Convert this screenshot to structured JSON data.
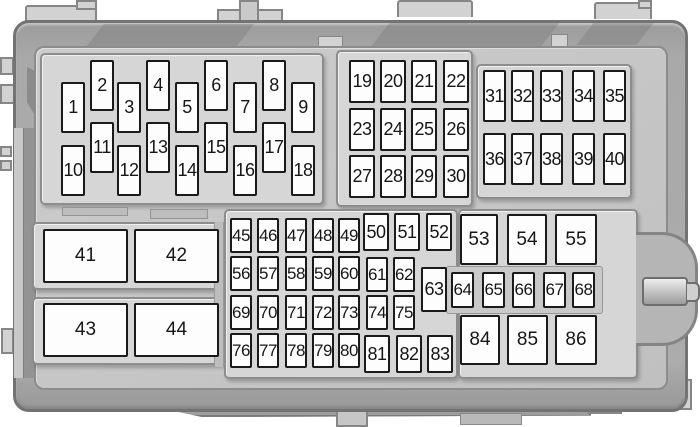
{
  "diagram": {
    "kind": "fuse-box",
    "fuse_fill": "#fdfdfd",
    "fuse_border": "#1a1a1a",
    "label_color": "#161616",
    "housing_color": "#a9a9a9",
    "panel_color": "#c6c6c6",
    "tray_color": "#d6d6d6",
    "background": "#ffffff"
  },
  "fuse_groups": [
    {
      "name": "fuse-block-1-18",
      "kind": "fuse",
      "cls": "",
      "w": 24,
      "h": 51,
      "fuses": [
        {
          "l": "1",
          "x": 61,
          "y": 82
        },
        {
          "l": "2",
          "x": 90,
          "y": 60
        },
        {
          "l": "3",
          "x": 117,
          "y": 82
        },
        {
          "l": "4",
          "x": 146,
          "y": 60
        },
        {
          "l": "5",
          "x": 175,
          "y": 82
        },
        {
          "l": "6",
          "x": 204,
          "y": 60
        },
        {
          "l": "7",
          "x": 233,
          "y": 82
        },
        {
          "l": "8",
          "x": 262,
          "y": 60
        },
        {
          "l": "9",
          "x": 291,
          "y": 82
        },
        {
          "l": "10",
          "x": 61,
          "y": 145
        },
        {
          "l": "11",
          "x": 90,
          "y": 122
        },
        {
          "l": "12",
          "x": 117,
          "y": 145
        },
        {
          "l": "13",
          "x": 146,
          "y": 122
        },
        {
          "l": "14",
          "x": 175,
          "y": 145
        },
        {
          "l": "15",
          "x": 204,
          "y": 122
        },
        {
          "l": "16",
          "x": 233,
          "y": 145
        },
        {
          "l": "17",
          "x": 262,
          "y": 122
        },
        {
          "l": "18",
          "x": 291,
          "y": 145
        }
      ]
    },
    {
      "name": "fuse-block-19-30",
      "kind": "fuse",
      "cls": "",
      "w": 26,
      "h": 43,
      "fuses": [
        {
          "l": "19",
          "x": 349,
          "y": 60
        },
        {
          "l": "20",
          "x": 380,
          "y": 60
        },
        {
          "l": "21",
          "x": 411,
          "y": 60
        },
        {
          "l": "22",
          "x": 443,
          "y": 60
        },
        {
          "l": "23",
          "x": 349,
          "y": 108
        },
        {
          "l": "24",
          "x": 380,
          "y": 108
        },
        {
          "l": "25",
          "x": 411,
          "y": 108
        },
        {
          "l": "26",
          "x": 443,
          "y": 108
        },
        {
          "l": "27",
          "x": 349,
          "y": 155
        },
        {
          "l": "28",
          "x": 380,
          "y": 155
        },
        {
          "l": "29",
          "x": 411,
          "y": 155
        },
        {
          "l": "30",
          "x": 443,
          "y": 155
        }
      ]
    },
    {
      "name": "fuse-block-31-40",
      "kind": "fuse",
      "cls": "",
      "w": 23,
      "h": 52,
      "fuses": [
        {
          "l": "31",
          "x": 483,
          "y": 70
        },
        {
          "l": "32",
          "x": 511,
          "y": 70
        },
        {
          "l": "33",
          "x": 540,
          "y": 70
        },
        {
          "l": "34",
          "x": 572,
          "y": 70
        },
        {
          "l": "35",
          "x": 603,
          "y": 70
        },
        {
          "l": "36",
          "x": 483,
          "y": 133
        },
        {
          "l": "37",
          "x": 511,
          "y": 133
        },
        {
          "l": "38",
          "x": 540,
          "y": 133
        },
        {
          "l": "39",
          "x": 572,
          "y": 133
        },
        {
          "l": "40",
          "x": 603,
          "y": 133
        }
      ]
    },
    {
      "name": "relay-block-41-44",
      "kind": "relay",
      "cls": "lg",
      "w": 85,
      "h": 54,
      "fuses": [
        {
          "l": "41",
          "x": 43,
          "y": 229
        },
        {
          "l": "42",
          "x": 134,
          "y": 229
        },
        {
          "l": "43",
          "x": 43,
          "y": 303
        },
        {
          "l": "44",
          "x": 134,
          "y": 303
        }
      ]
    },
    {
      "name": "lower-grid-small-fuses",
      "kind": "fuse",
      "cls": "sm",
      "w": 22,
      "h": 35,
      "fuses": [
        {
          "l": "45",
          "x": 230,
          "y": 218
        },
        {
          "l": "46",
          "x": 257,
          "y": 218
        },
        {
          "l": "47",
          "x": 285,
          "y": 218
        },
        {
          "l": "48",
          "x": 312,
          "y": 218
        },
        {
          "l": "49",
          "x": 338,
          "y": 218
        },
        {
          "l": "56",
          "x": 230,
          "y": 256
        },
        {
          "l": "57",
          "x": 257,
          "y": 256
        },
        {
          "l": "58",
          "x": 285,
          "y": 256
        },
        {
          "l": "59",
          "x": 312,
          "y": 256
        },
        {
          "l": "60",
          "x": 338,
          "y": 256
        },
        {
          "l": "61",
          "x": 366,
          "y": 257
        },
        {
          "l": "62",
          "x": 393,
          "y": 257
        },
        {
          "l": "69",
          "x": 230,
          "y": 295
        },
        {
          "l": "70",
          "x": 257,
          "y": 295
        },
        {
          "l": "71",
          "x": 285,
          "y": 295
        },
        {
          "l": "72",
          "x": 312,
          "y": 295
        },
        {
          "l": "73",
          "x": 338,
          "y": 295
        },
        {
          "l": "74",
          "x": 366,
          "y": 295
        },
        {
          "l": "75",
          "x": 393,
          "y": 295
        },
        {
          "l": "76",
          "x": 230,
          "y": 333
        },
        {
          "l": "77",
          "x": 257,
          "y": 333
        },
        {
          "l": "78",
          "x": 285,
          "y": 333
        },
        {
          "l": "79",
          "x": 312,
          "y": 333
        },
        {
          "l": "80",
          "x": 338,
          "y": 333
        }
      ]
    },
    {
      "name": "lower-grid-large-fuses",
      "kind": "fuse",
      "cls": "",
      "w": 26,
      "h": 38,
      "fuses": [
        {
          "l": "50",
          "x": 363,
          "y": 213
        },
        {
          "l": "51",
          "x": 394,
          "y": 213
        },
        {
          "l": "52",
          "x": 426,
          "y": 213
        },
        {
          "l": "63",
          "x": 421,
          "y": 267,
          "h": 45
        },
        {
          "l": "81",
          "x": 364,
          "y": 335
        },
        {
          "l": "82",
          "x": 396,
          "y": 335
        },
        {
          "l": "83",
          "x": 427,
          "y": 335
        }
      ]
    },
    {
      "name": "relay-block-53-55",
      "kind": "relay",
      "cls": "lg",
      "w": 40,
      "h": 51,
      "fuses": [
        {
          "l": "53",
          "x": 460,
          "y": 214,
          "w": 38
        },
        {
          "l": "54",
          "x": 507,
          "y": 214,
          "w": 40
        },
        {
          "l": "55",
          "x": 555,
          "y": 214,
          "w": 42
        }
      ]
    },
    {
      "name": "fuse-row-64-68",
      "kind": "fuse",
      "cls": "sm",
      "w": 23,
      "h": 36,
      "fuses": [
        {
          "l": "64",
          "x": 451,
          "y": 272
        },
        {
          "l": "65",
          "x": 482,
          "y": 272
        },
        {
          "l": "66",
          "x": 512,
          "y": 272
        },
        {
          "l": "67",
          "x": 543,
          "y": 272
        },
        {
          "l": "68",
          "x": 572,
          "y": 272
        }
      ]
    },
    {
      "name": "relay-block-84-86",
      "kind": "relay",
      "cls": "lg",
      "w": 40,
      "h": 50,
      "fuses": [
        {
          "l": "84",
          "x": 460,
          "y": 315,
          "w": 40
        },
        {
          "l": "85",
          "x": 507,
          "y": 315,
          "w": 41
        },
        {
          "l": "86",
          "x": 555,
          "y": 315,
          "w": 42
        }
      ]
    }
  ]
}
